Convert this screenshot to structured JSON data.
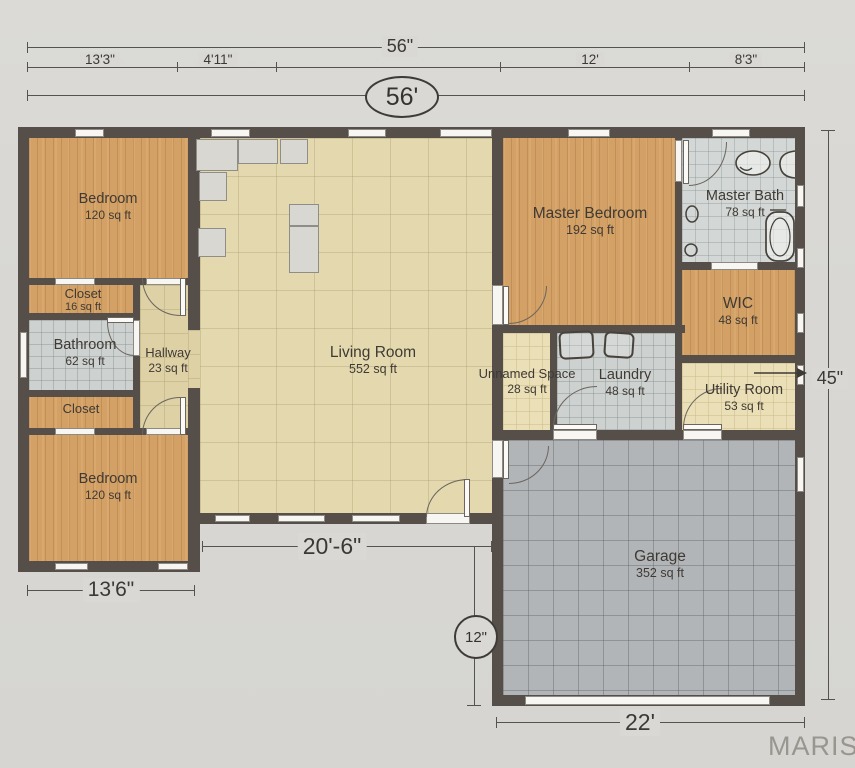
{
  "watermark": "MARIS",
  "dimensions": {
    "top_overall": "56\"",
    "seg1": "13'3\"",
    "seg2": "4'11\"",
    "seg3": "12'",
    "seg4": "8'3\"",
    "oval_total": "56'",
    "right_height": "45\"",
    "bedroom_width": "13'6\"",
    "living_width": "20'-6\"",
    "porch_depth": "12\"",
    "garage_width": "22'"
  },
  "rooms": {
    "bedroom_top": {
      "label": "Bedroom",
      "area": "120 sq ft"
    },
    "closet_top": {
      "label": "Closet",
      "area": "16 sq ft"
    },
    "bathroom": {
      "label": "Bathroom",
      "area": "62 sq ft"
    },
    "closet_bottom": {
      "label": "Closet"
    },
    "bedroom_bottom": {
      "label": "Bedroom",
      "area": "120 sq ft"
    },
    "hallway": {
      "label": "Hallway",
      "area": "23 sq ft"
    },
    "living": {
      "label": "Living Room",
      "area": "552 sq ft"
    },
    "master_bedroom": {
      "label": "Master Bedroom",
      "area": "192 sq ft"
    },
    "master_bath": {
      "label": "Master Bath",
      "area": "78 sq ft"
    },
    "wic": {
      "label": "WIC",
      "area": "48 sq ft"
    },
    "unnamed": {
      "label": "Unnamed Space",
      "area": "28 sq ft"
    },
    "laundry": {
      "label": "Laundry",
      "area": "48 sq ft"
    },
    "utility": {
      "label": "Utility Room",
      "area": "53 sq ft"
    },
    "garage": {
      "label": "Garage",
      "area": "352 sq ft"
    }
  }
}
